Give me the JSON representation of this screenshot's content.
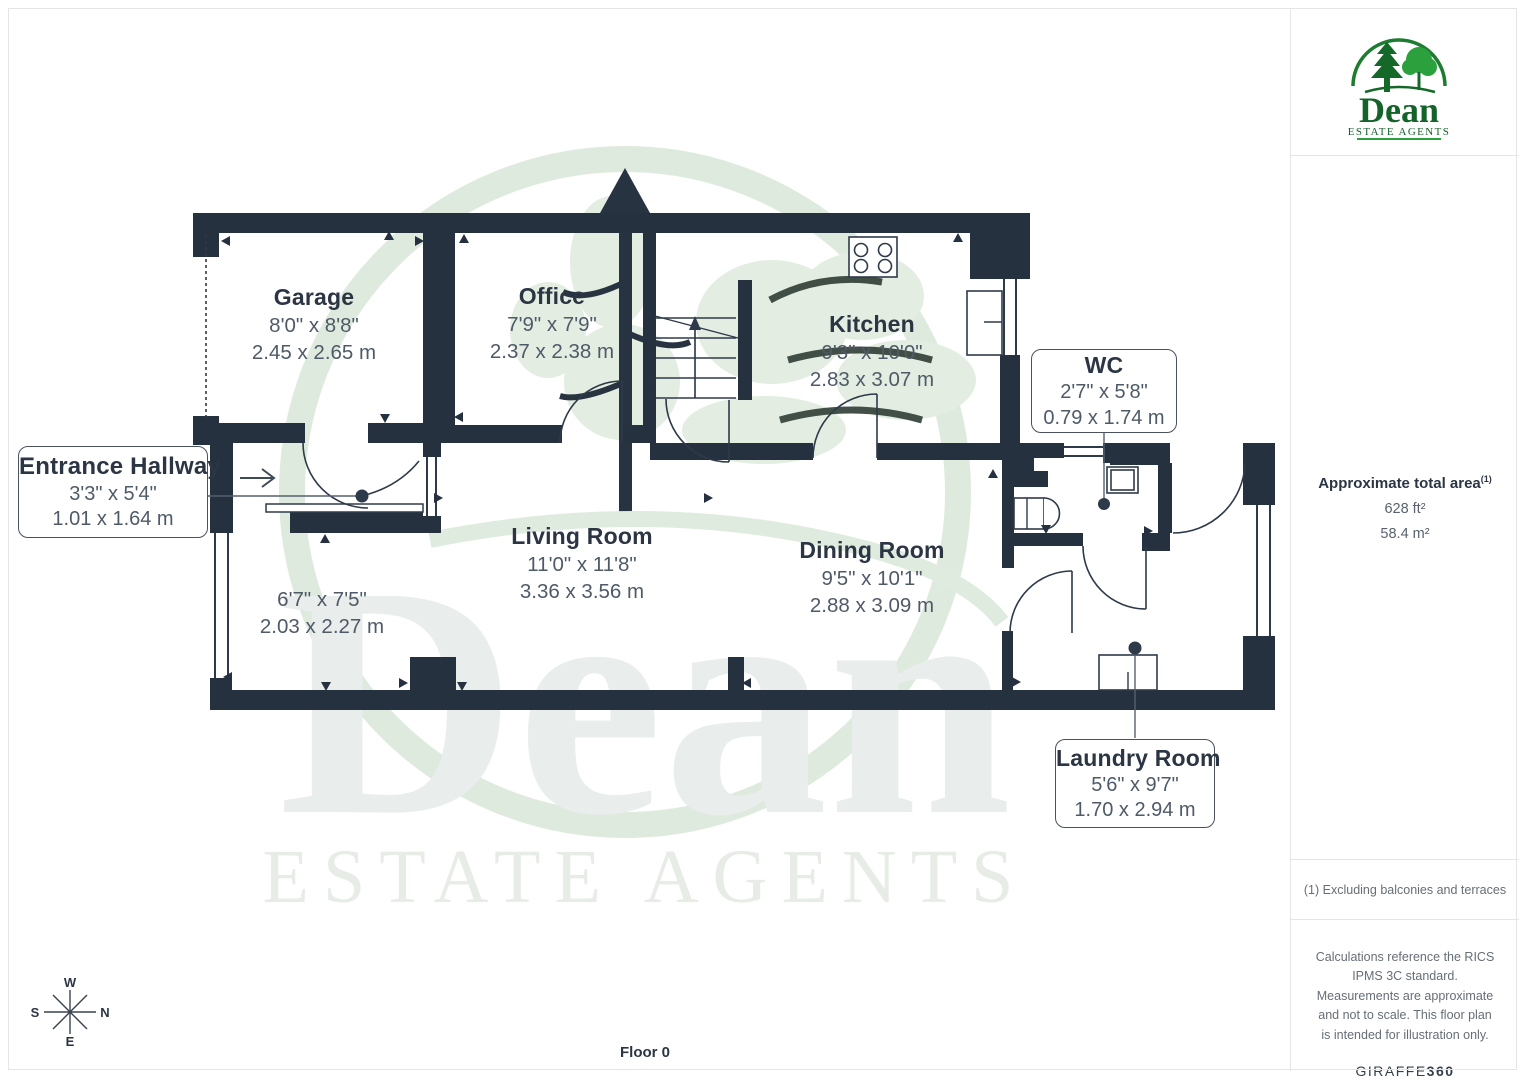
{
  "brand": {
    "name": "Dean",
    "tagline": "ESTATE AGENTS"
  },
  "watermark": {
    "name": "Dean",
    "tagline": "ESTATE AGENTS"
  },
  "sidebar": {
    "area_label": "Approximate total area",
    "area_footnote_marker": "(1)",
    "area_imperial": "628 ft²",
    "area_metric": "58.4 m²",
    "footnote": "(1) Excluding balconies and terraces",
    "disclaimer": "Calculations reference the RICS IPMS 3C standard. Measurements are approximate and not to scale. This floor plan is intended for illustration only.",
    "provider_name": "GIRAFFE",
    "provider_suffix": "360"
  },
  "floor_label": "Floor 0",
  "compass": {
    "top": "W",
    "right": "N",
    "bottom": "E",
    "left": "S"
  },
  "rooms": {
    "garage": {
      "name": "Garage",
      "imperial": "8'0\" x 8'8\"",
      "metric": "2.45 x 2.65 m"
    },
    "office": {
      "name": "Office",
      "imperial": "7'9\" x 7'9\"",
      "metric": "2.37 x 2.38 m"
    },
    "kitchen": {
      "name": "Kitchen",
      "imperial": "9'3\" x 10'0\"",
      "metric": "2.83 x 3.07 m"
    },
    "living": {
      "name": "Living Room",
      "imperial": "11'0\" x 11'8\"",
      "metric": "3.36 x 3.56 m"
    },
    "dining": {
      "name": "Dining Room",
      "imperial": "9'5\" x 10'1\"",
      "metric": "2.88 x 3.09 m"
    },
    "nook": {
      "imperial": "6'7\" x 7'5\"",
      "metric": "2.03 x 2.27 m"
    },
    "entrance": {
      "name": "Entrance Hallway",
      "imperial": "3'3\" x 5'4\"",
      "metric": "1.01 x 1.64 m"
    },
    "wc": {
      "name": "WC",
      "imperial": "2'7\" x 5'8\"",
      "metric": "0.79 x 1.74 m"
    },
    "laundry": {
      "name": "Laundry Room",
      "imperial": "5'6\" x 9'7\"",
      "metric": "1.70 x 2.94 m"
    }
  },
  "colors": {
    "wall": "#263140",
    "accent_green": "#1b7a2f",
    "text_dark": "#2b3543",
    "text_dim": "#4f5a68"
  }
}
